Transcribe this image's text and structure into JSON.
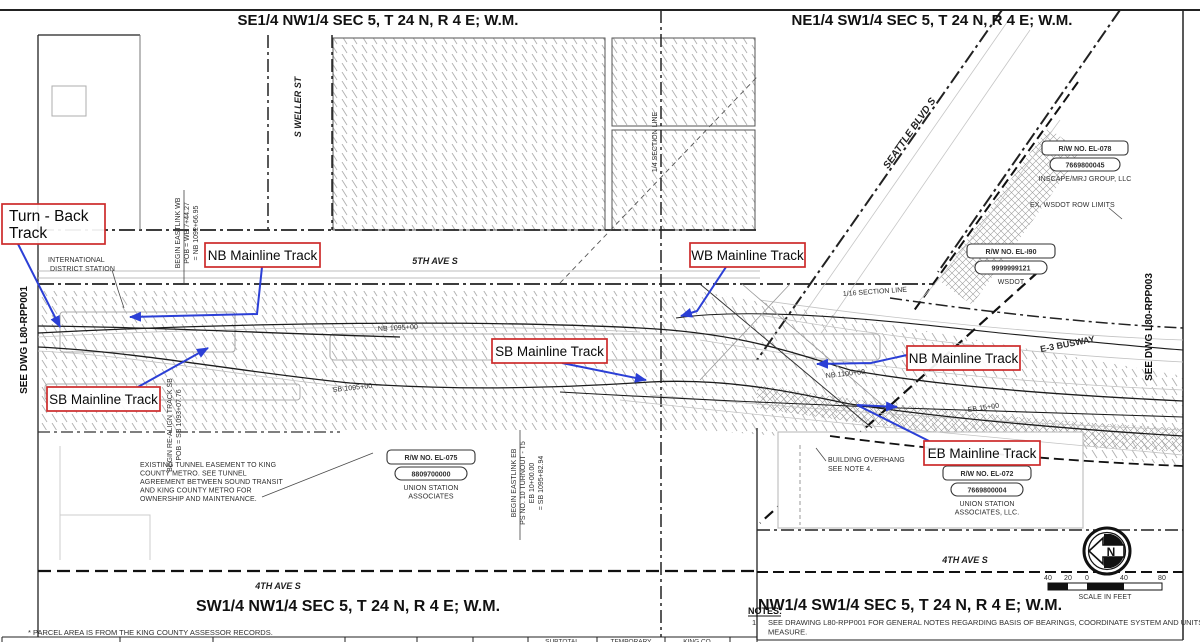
{
  "titles": {
    "top_left": "SE1/4 NW1/4 SEC 5, T 24 N, R 4 E; W.M.",
    "top_right": "NE1/4 SW1/4 SEC 5, T 24 N, R 4 E; W.M.",
    "bottom_left": "SW1/4 NW1/4 SEC 5, T 24 N, R 4 E; W.M.",
    "bottom_right": "NW1/4 SW1/4 SEC 5, T 24 N, R 4 E; W.M."
  },
  "streets": {
    "fifth_ave": "5TH AVE S",
    "weller": "S WELLER ST",
    "seattle_blvd": "SEATTLE BLVD S",
    "fourth_ave_right": "4TH AVE S",
    "fourth_ave_left": "4TH AVE S",
    "busway": "E-3 BUSWAY"
  },
  "track_labels": {
    "turn_back_line1": "Turn - Back",
    "turn_back_line2": "Track",
    "nb_left": "NB Mainline Track",
    "wb": "WB Mainline Track",
    "sb_center": "SB Mainline Track",
    "nb_right": "NB Mainline Track",
    "sb_left": "SB Mainline Track",
    "eb": "EB Mainline Track"
  },
  "see_dwg": {
    "left": "SEE DWG L80-RPP001",
    "right": "SEE DWG L80-RPP003"
  },
  "section_lines": {
    "quarter": "1/4 SECTION LINE",
    "sixteenth": "1/16 SECTION LINE"
  },
  "station": {
    "line1": "INTERNATIONAL",
    "line2": "DISTRICT STATION"
  },
  "alignment_notes": {
    "begin_eastlink_wb": [
      "BEGIN EASTLINK WB",
      "POB = WB 7+44.27",
      "= NB 1092+66.95"
    ],
    "begin_realign_sb": [
      "BEGIN RE-ALIGN TRACK SB",
      "POB = SB 1093+07.76"
    ],
    "begin_eastlink_eb": [
      "BEGIN EASTLINK EB",
      "PS NO. 10 TURNOUT - T5",
      "EB 10+00.00",
      "= SB 1095+82.94"
    ]
  },
  "stationing": {
    "nb_1095": "NB 1095+00",
    "sb_1095": "SB 1095+00",
    "nb_1100": "NB 1100+00",
    "eb_15": "EB 15+00"
  },
  "parcels": {
    "el078": {
      "id": "R/W NO. EL-078",
      "num": "7669800045",
      "owner1": "INSCAPE/MRJ GROUP, LLC"
    },
    "el090": {
      "id": "R/W NO. EL-I90",
      "num": "9999999121",
      "owner1": "WSDOT"
    },
    "el075": {
      "id": "R/W NO. EL-075",
      "num": "8809700000",
      "owner1": "UNION STATION",
      "owner2": "ASSOCIATES"
    },
    "el072": {
      "id": "R/W NO. EL-072",
      "num": "7669800004",
      "owner1": "UNION STATION",
      "owner2": "ASSOCIATES, LLC."
    }
  },
  "annotations": {
    "wsdot_row": "EX. WSDOT ROW LIMITS",
    "tunnel_easement": [
      "EXISTING TUNNEL EASEMENT TO KING",
      "COUNTY METRO.  SEE TUNNEL",
      "AGREEMENT BETWEEN SOUND TRANSIT",
      "AND KING COUNTY METRO FOR",
      "OWNERSHIP AND MAINTENANCE."
    ],
    "building_overhang": [
      "BUILDING OVERHANG",
      "SEE NOTE 4."
    ]
  },
  "notes": {
    "heading": "NOTES:",
    "item1_num": "1.",
    "item1_line1": "SEE DRAWING L80-RPP001 FOR GENERAL NOTES REGARDING BASIS OF BEARINGS, COORDINATE SYSTEM AND UNITS OF",
    "item1_line2": "MEASURE."
  },
  "footer": {
    "parcel_note": "* PARCEL AREA IS FROM THE KING COUNTY ASSESSOR RECORDS."
  },
  "scale_bar": {
    "ticks": [
      "40",
      "20",
      "0",
      "40",
      "80"
    ],
    "caption": "SCALE IN FEET"
  },
  "north_arrow": {
    "letter": "N"
  },
  "table_stub": {
    "col1": "SUBTOTAL",
    "col2": "TEMPORARY",
    "col3": "KING CO"
  },
  "colors": {
    "label_red": "#cc2a2a",
    "arrow_blue": "#2b3fd6",
    "hatch_gray": "#b0b0b0"
  }
}
